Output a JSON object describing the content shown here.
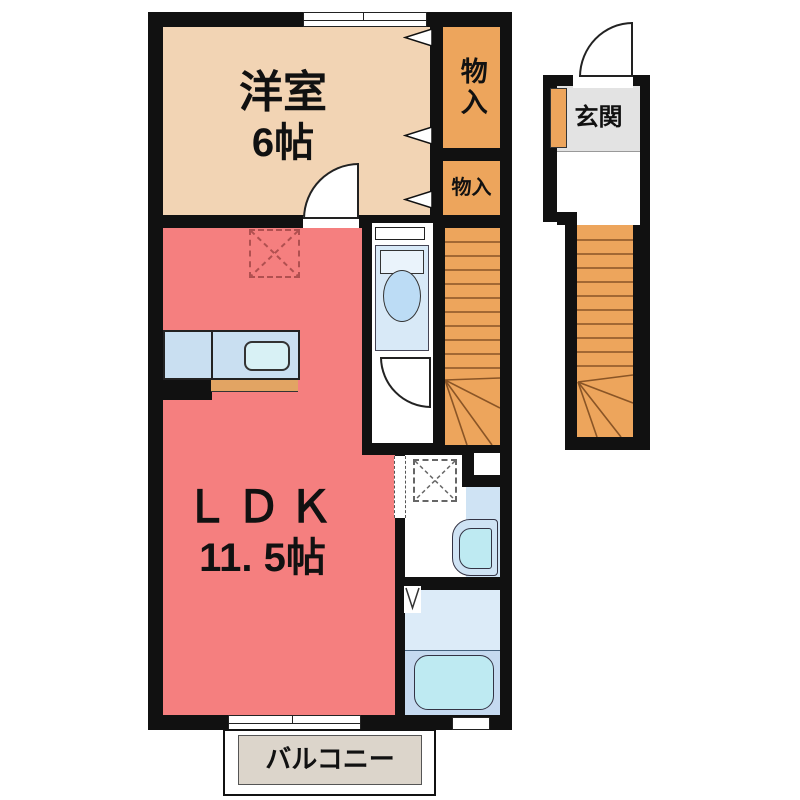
{
  "floorplan": {
    "type_note": "1LDK apartment floor plan",
    "rooms": {
      "western_room": {
        "name": "洋室",
        "size": "6帖"
      },
      "ldk": {
        "name": "ＬＤＫ",
        "size": "11. 5帖"
      },
      "closet_upper": {
        "name": "物入"
      },
      "closet_lower": {
        "name": "物入"
      },
      "entrance": {
        "name": "玄関"
      },
      "balcony": {
        "name": "バルコニー"
      }
    },
    "colors": {
      "wall": "#111111",
      "western-room": "#F2D4B4",
      "storage": "#EDA55C",
      "ldk": "#F57F7F",
      "water-blue": "#D8E9F7",
      "fixture-cyan": "#BEEAF2",
      "counter-blue": "#C9DFF1",
      "counter-strip": "#E2A463",
      "entrance-gray": "#E3E3E3",
      "balcony-beige": "#DCD5CB",
      "bath-floor": "#DCEBF8",
      "bath-floor-lower": "#C5DAF0",
      "vanity-blue": "#CFE3F4",
      "stair-line": "#8A5526",
      "marker-red": "#B05050",
      "marker-gray": "#666666"
    }
  }
}
